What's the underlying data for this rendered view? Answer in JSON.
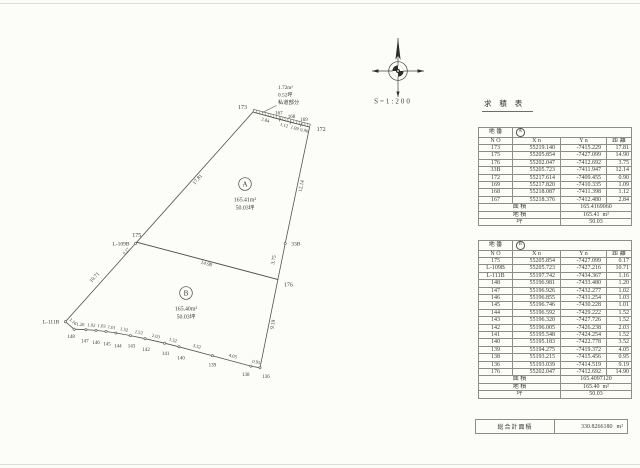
{
  "scale_label": "S=1:200",
  "table_title": "求 積 表",
  "annotation": {
    "area": "1.72m²",
    "tsubo": "0.52坪",
    "label": "私道部分"
  },
  "regions": [
    {
      "id": "A",
      "area": "165.41m²",
      "tsubo": "50.03坪"
    },
    {
      "id": "B",
      "area": "165.40m²",
      "tsubo": "50.03坪"
    }
  ],
  "tables": [
    {
      "lot_label": "地 番",
      "lot_id": "A",
      "columns": [
        "N O",
        "X n",
        "Y n",
        "距 離"
      ],
      "rows": [
        [
          "173",
          "55219.140",
          "-7415.229",
          "17.81"
        ],
        [
          "175",
          "55205.854",
          "-7427.099",
          "14.90"
        ],
        [
          "176",
          "55202.047",
          "-7412.692",
          "3.75"
        ],
        [
          "33B",
          "55205.723",
          "-7411.947",
          "12.14"
        ],
        [
          "172",
          "55217.614",
          "-7409.455",
          "0.90"
        ],
        [
          "169",
          "55217.820",
          "-7410.335",
          "1.09"
        ],
        [
          "168",
          "55218.087",
          "-7411.398",
          "1.12"
        ],
        [
          "167",
          "55218.376",
          "-7412.480",
          "2.84"
        ]
      ],
      "area_label": "面 積",
      "area_value": "165.4169060",
      "chiseki_label": "地 積",
      "chiseki_value": "165.41",
      "chiseki_unit": "m²",
      "tsubo_label": "坪",
      "tsubo_value": "50.03"
    },
    {
      "lot_label": "地 番",
      "lot_id": "B",
      "columns": [
        "N O",
        "X n",
        "Y n",
        "距 離"
      ],
      "rows": [
        [
          "175",
          "55205.854",
          "-7427.099",
          "0.17"
        ],
        [
          "L-109B",
          "55205.723",
          "-7427.216",
          "10.71"
        ],
        [
          "L-111B",
          "55197.742",
          "-7434.367",
          "1.16"
        ],
        [
          "148",
          "55196.981",
          "-7433.480",
          "1.20"
        ],
        [
          "147",
          "55196.926",
          "-7432.277",
          "1.02"
        ],
        [
          "146",
          "55196.855",
          "-7431.254",
          "1.03"
        ],
        [
          "145",
          "55196.746",
          "-7430.228",
          "1.01"
        ],
        [
          "144",
          "55196.592",
          "-7429.222",
          "1.52"
        ],
        [
          "143",
          "55196.320",
          "-7427.726",
          "1.52"
        ],
        [
          "142",
          "55196.005",
          "-7426.238",
          "2.03"
        ],
        [
          "141",
          "55195.548",
          "-7424.254",
          "1.52"
        ],
        [
          "140",
          "55195.183",
          "-7422.778",
          "3.52"
        ],
        [
          "139",
          "55194.275",
          "-7419.372",
          "4.05"
        ],
        [
          "138",
          "55193.215",
          "-7415.456",
          "0.95"
        ],
        [
          "136",
          "55193.039",
          "-7414.519",
          "9.19"
        ],
        [
          "176",
          "55202.047",
          "-7412.692",
          "14.90"
        ]
      ],
      "area_label": "面 積",
      "area_value": "165.4097120",
      "chiseki_label": "地 積",
      "chiseki_value": "165.40",
      "chiseki_unit": "m²",
      "tsubo_label": "坪",
      "tsubo_value": "50.03"
    }
  ],
  "total": {
    "label": "総合計面積",
    "value": "330.8266180",
    "unit": "m²"
  },
  "plot": {
    "points": {
      "173": [
        55219.14,
        -7415.229
      ],
      "167": [
        55218.376,
        -7412.48
      ],
      "168": [
        55218.087,
        -7411.398
      ],
      "169": [
        55217.82,
        -7410.335
      ],
      "172": [
        55217.614,
        -7409.455
      ],
      "33B": [
        55205.723,
        -7411.947
      ],
      "176": [
        55202.047,
        -7412.692
      ],
      "175": [
        55205.854,
        -7427.099
      ],
      "L-109B": [
        55205.723,
        -7427.216
      ],
      "L-111B": [
        55197.742,
        -7434.367
      ],
      "148": [
        55196.981,
        -7433.48
      ],
      "147": [
        55196.926,
        -7432.277
      ],
      "146": [
        55196.855,
        -7431.254
      ],
      "145": [
        55196.746,
        -7430.228
      ],
      "144": [
        55196.592,
        -7429.222
      ],
      "143": [
        55196.32,
        -7427.726
      ],
      "142": [
        55196.005,
        -7426.238
      ],
      "141": [
        55195.548,
        -7424.254
      ],
      "140": [
        55195.183,
        -7422.778
      ],
      "139": [
        55194.275,
        -7419.372
      ],
      "138": [
        55193.215,
        -7415.456
      ],
      "136": [
        55193.039,
        -7414.519
      ]
    },
    "polygon_a": [
      "173",
      "167",
      "168",
      "169",
      "172",
      "33B",
      "176",
      "175"
    ],
    "polygon_b": [
      "175",
      "L-109B",
      "L-111B",
      "148",
      "147",
      "146",
      "145",
      "144",
      "143",
      "142",
      "141",
      "140",
      "139",
      "138",
      "136",
      "176"
    ],
    "strip": {
      "path": [
        "173",
        "167",
        "168",
        "169",
        "172"
      ],
      "distances": [
        "2.84",
        "1.12",
        "1.09",
        "0.90"
      ]
    },
    "chain": [
      "L-111B",
      "148",
      "147",
      "146",
      "145",
      "144",
      "143",
      "142",
      "141",
      "140",
      "139",
      "138",
      "136"
    ],
    "chain_distances": [
      "1.16",
      "1.20",
      "1.02",
      "1.03",
      "1.01",
      "1.52",
      "1.52",
      "2.03",
      "1.52",
      "3.52",
      "4.05",
      "0.95"
    ],
    "edge_labels": [
      {
        "a": "175",
        "b": "173",
        "text": "17.81",
        "off": 5
      },
      {
        "a": "175",
        "b": "176",
        "text": "14.90",
        "off": 4.5
      },
      {
        "a": "33B",
        "b": "172",
        "text": "12.14",
        "off": 5.5
      },
      {
        "a": "176",
        "b": "33B",
        "text": "3.75",
        "off": -6.5
      },
      {
        "a": "136",
        "b": "176",
        "text": "9.19",
        "off": 5.5
      },
      {
        "a": "L-111B",
        "b": "L-109B",
        "text": "10.71",
        "off": -6.5
      }
    ],
    "free_labels": [
      {
        "x": 127,
        "y": 252,
        "text": "0.17",
        "angle": -48,
        "fs": 4.2
      }
    ],
    "point_labels": [
      {
        "id": "173",
        "dx": -6,
        "dy": -3,
        "anchor": "end",
        "fs": 6
      },
      {
        "id": "167",
        "dx": -1,
        "dy": -5,
        "anchor": "middle",
        "fs": 5
      },
      {
        "id": "168",
        "dx": 1,
        "dy": -4.5,
        "anchor": "middle",
        "fs": 5
      },
      {
        "id": "169",
        "dx": 3,
        "dy": -4,
        "anchor": "middle",
        "fs": 5
      },
      {
        "id": "172",
        "dx": 7,
        "dy": 4,
        "anchor": "start",
        "fs": 6
      },
      {
        "id": "33B",
        "dx": 6,
        "dy": 2,
        "anchor": "start",
        "fs": 5.5
      },
      {
        "id": "176",
        "dx": 6,
        "dy": 7,
        "anchor": "start",
        "fs": 6
      },
      {
        "id": "175",
        "dx": 0,
        "dy": -5,
        "anchor": "middle",
        "fs": 6
      },
      {
        "id": "L-109B",
        "dx": -6,
        "dy": 2,
        "anchor": "end",
        "fs": 5.5
      },
      {
        "id": "L-111B",
        "dx": -6,
        "dy": 2,
        "anchor": "end",
        "fs": 5.5
      },
      {
        "id": "148",
        "dx": -3,
        "dy": 9,
        "anchor": "middle",
        "fs": 5
      },
      {
        "id": "147",
        "dx": -1,
        "dy": 13,
        "anchor": "middle",
        "fs": 5
      },
      {
        "id": "146",
        "dx": 0,
        "dy": 13.5,
        "anchor": "middle",
        "fs": 5
      },
      {
        "id": "145",
        "dx": 1,
        "dy": 14,
        "anchor": "middle",
        "fs": 5
      },
      {
        "id": "144",
        "dx": 2,
        "dy": 14.5,
        "anchor": "middle",
        "fs": 5
      },
      {
        "id": "143",
        "dx": 1,
        "dy": 12,
        "anchor": "middle",
        "fs": 5
      },
      {
        "id": "142",
        "dx": 1,
        "dy": 12.5,
        "anchor": "middle",
        "fs": 5
      },
      {
        "id": "141",
        "dx": 1,
        "dy": 12,
        "anchor": "middle",
        "fs": 5
      },
      {
        "id": "140",
        "dx": 2,
        "dy": 12.5,
        "anchor": "middle",
        "fs": 5
      },
      {
        "id": "139",
        "dx": 0,
        "dy": 11,
        "anchor": "middle",
        "fs": 5
      },
      {
        "id": "138",
        "dx": -5,
        "dy": 10,
        "anchor": "middle",
        "fs": 5
      },
      {
        "id": "136",
        "dx": 6,
        "dy": 10,
        "anchor": "middle",
        "fs": 5
      }
    ],
    "markers": [
      "L-109B",
      "L-111B",
      "148",
      "147",
      "146",
      "145",
      "144",
      "143",
      "142",
      "141",
      "140",
      "139",
      "138",
      "136",
      "33B"
    ]
  }
}
